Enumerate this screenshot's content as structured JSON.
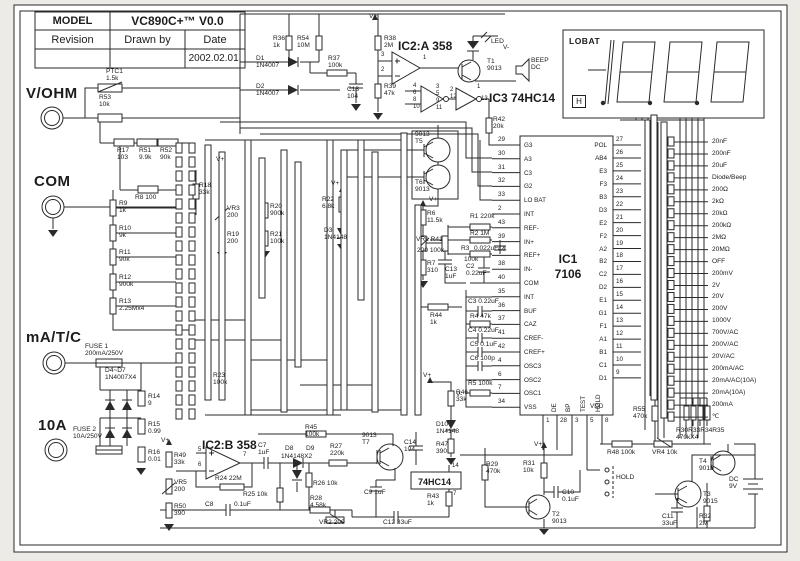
{
  "colors": {
    "ink": "#2a2a2a",
    "paper": "#ffffff"
  },
  "title_block": {
    "model_label": "MODEL",
    "model_value": "VC890C+™ V0.0",
    "revision_label": "Revision",
    "drawn_by_label": "Drawn by",
    "date_label": "Date",
    "date_value": "2002.02.01."
  },
  "display": {
    "lobat": "LOBAT",
    "hold": "H"
  },
  "ic1": {
    "name": "IC1",
    "part": "7106",
    "left_pins": [
      [
        "29",
        "G3"
      ],
      [
        "30",
        "A3"
      ],
      [
        "31",
        "C3"
      ],
      [
        "32",
        "G2"
      ],
      [
        "33",
        "LO BAT"
      ],
      [
        "2",
        "INT"
      ],
      [
        "43",
        "REF-"
      ],
      [
        "39",
        "IN+"
      ],
      [
        "44",
        "REF+"
      ],
      [
        "38",
        "IN-"
      ],
      [
        "40",
        "COM"
      ],
      [
        "35",
        "INT"
      ],
      [
        "36",
        "BUF"
      ],
      [
        "37",
        "CAZ"
      ],
      [
        "41",
        "CREF-"
      ],
      [
        "42",
        "CREF+"
      ],
      [
        "4",
        "OSC3"
      ],
      [
        "6",
        "OSC2"
      ],
      [
        "7",
        "OSC1"
      ],
      [
        "34",
        "VSS"
      ]
    ],
    "right_pins": [
      [
        "27",
        "POL"
      ],
      [
        "26",
        "AB4"
      ],
      [
        "25",
        "E3"
      ],
      [
        "24",
        "F3"
      ],
      [
        "23",
        "B3"
      ],
      [
        "22",
        "D3"
      ],
      [
        "21",
        "E2"
      ],
      [
        "20",
        "F2"
      ],
      [
        "19",
        "A2"
      ],
      [
        "18",
        "B2"
      ],
      [
        "17",
        "C2"
      ],
      [
        "16",
        "D2"
      ],
      [
        "15",
        "E1"
      ],
      [
        "14",
        "G1"
      ],
      [
        "13",
        "F1"
      ],
      [
        "12",
        "A1"
      ],
      [
        "11",
        "B1"
      ],
      [
        "10",
        "C1"
      ],
      [
        "9",
        "D1"
      ]
    ],
    "bottom_pins": [
      [
        "1",
        "DE"
      ],
      [
        "28",
        "BP"
      ],
      [
        "3",
        "TEST"
      ],
      [
        "5",
        "HOLD"
      ],
      [
        "8",
        "VDD"
      ]
    ]
  },
  "ranges": [
    "20nF",
    "200nF",
    "20uF",
    "Diode/Beep",
    "200Ω",
    "2kΩ",
    "20kΩ",
    "200kΩ",
    "2MΩ",
    "20MΩ",
    "OFF",
    "200mV",
    "2V",
    "20V",
    "200V",
    "1000V",
    "700V/AC",
    "200V/AC",
    "20V/AC",
    "200mA/AC",
    "20mA/AC(10A)",
    "20mA(10A)",
    "200mA",
    "℃"
  ],
  "labels": [
    {
      "t": "V/OHM",
      "x": 26,
      "y": 86,
      "c": "big"
    },
    {
      "t": "COM",
      "x": 34,
      "y": 174,
      "c": "big"
    },
    {
      "t": "mA/T/C",
      "x": 26,
      "y": 330,
      "c": "big"
    },
    {
      "t": "10A",
      "x": 38,
      "y": 418,
      "c": "big"
    },
    {
      "t": "PTC1\n1.5k",
      "x": 106,
      "y": 68
    },
    {
      "t": "R53\n10k",
      "x": 99,
      "y": 94
    },
    {
      "t": "R17\n103",
      "x": 117,
      "y": 147
    },
    {
      "t": "R51\n9.9k",
      "x": 139,
      "y": 147
    },
    {
      "t": "R52\n90k",
      "x": 160,
      "y": 147
    },
    {
      "t": "R8  100",
      "x": 135,
      "y": 194
    },
    {
      "t": "R9\n1k",
      "x": 119,
      "y": 200
    },
    {
      "t": "R10\n9k",
      "x": 119,
      "y": 225
    },
    {
      "t": "R11\n90k",
      "x": 119,
      "y": 249
    },
    {
      "t": "R12\n900k",
      "x": 119,
      "y": 274
    },
    {
      "t": "R13\n2.25Mx4",
      "x": 119,
      "y": 298
    },
    {
      "t": "FUSE 1\n200mA/250V",
      "x": 85,
      "y": 343
    },
    {
      "t": "D4~D7\n1N4007X4",
      "x": 105,
      "y": 367
    },
    {
      "t": "R14\n9",
      "x": 148,
      "y": 393
    },
    {
      "t": "R15\n0.99",
      "x": 148,
      "y": 421
    },
    {
      "t": "R16\n0.01",
      "x": 148,
      "y": 449
    },
    {
      "t": "FUSE 2\n10A/250V",
      "x": 73,
      "y": 426
    },
    {
      "t": "V+",
      "x": 161,
      "y": 437
    },
    {
      "t": "R49\n33k",
      "x": 174,
      "y": 452
    },
    {
      "t": "VR5\n200",
      "x": 174,
      "y": 479
    },
    {
      "t": "R50\n390",
      "x": 174,
      "y": 503
    },
    {
      "t": "V+",
      "x": 216,
      "y": 156
    },
    {
      "t": "R18\n33k",
      "x": 199,
      "y": 182
    },
    {
      "t": "VR3\n200",
      "x": 227,
      "y": 205
    },
    {
      "t": "R19\n200",
      "x": 227,
      "y": 231
    },
    {
      "t": "R20\n900k",
      "x": 270,
      "y": 203
    },
    {
      "t": "R21\n100k",
      "x": 270,
      "y": 231
    },
    {
      "t": "V+",
      "x": 331,
      "y": 180
    },
    {
      "t": "R22\n6.8k",
      "x": 322,
      "y": 196
    },
    {
      "t": "D3\n1N4148",
      "x": 324,
      "y": 227
    },
    {
      "t": "R23\n100k",
      "x": 213,
      "y": 372
    },
    {
      "t": "R36\n1k",
      "x": 273,
      "y": 35
    },
    {
      "t": "R54\n10M",
      "x": 297,
      "y": 35
    },
    {
      "t": "D1\n1N4007",
      "x": 256,
      "y": 55
    },
    {
      "t": "D2\n1N4007",
      "x": 256,
      "y": 83
    },
    {
      "t": "R37\n100k",
      "x": 328,
      "y": 55
    },
    {
      "t": "C13\n104",
      "x": 347,
      "y": 86
    },
    {
      "t": "V+",
      "x": 369,
      "y": 13
    },
    {
      "t": "R38\n2M",
      "x": 384,
      "y": 35
    },
    {
      "t": "R39\n47k",
      "x": 384,
      "y": 83
    },
    {
      "t": "IC2:A 358",
      "x": 398,
      "y": 40,
      "c": "ic"
    },
    {
      "t": "3",
      "x": 381,
      "y": 52,
      "c": "pin"
    },
    {
      "t": "2",
      "x": 381,
      "y": 67,
      "c": "pin"
    },
    {
      "t": "1",
      "x": 423,
      "y": 55,
      "c": "pin"
    },
    {
      "t": "LED",
      "x": 491,
      "y": 38
    },
    {
      "t": "V-",
      "x": 503,
      "y": 44
    },
    {
      "t": "T1\n9013",
      "x": 487,
      "y": 58
    },
    {
      "t": "BEEP\nDC",
      "x": 531,
      "y": 57
    },
    {
      "t": "IC3  74HC14",
      "x": 489,
      "y": 92,
      "c": "ic"
    },
    {
      "t": "4\n6\n8\n10",
      "x": 413,
      "y": 83,
      "c": "pin"
    },
    {
      "t": "3\n5\n9\n11",
      "x": 436,
      "y": 84,
      "c": "pin"
    },
    {
      "t": "2\n12",
      "x": 450,
      "y": 87,
      "c": "pin"
    },
    {
      "t": "1",
      "x": 477,
      "y": 84,
      "c": "pin"
    },
    {
      "t": "13",
      "x": 481,
      "y": 96,
      "c": "pin"
    },
    {
      "t": "R42\n20k",
      "x": 493,
      "y": 116
    },
    {
      "t": "9013\nT5",
      "x": 415,
      "y": 131
    },
    {
      "t": "T6\n9013",
      "x": 415,
      "y": 179
    },
    {
      "t": "V+",
      "x": 429,
      "y": 196
    },
    {
      "t": "R6\n11.5k",
      "x": 427,
      "y": 210
    },
    {
      "t": "VR1 R41",
      "x": 416,
      "y": 236
    },
    {
      "t": "200 100k",
      "x": 417,
      "y": 247
    },
    {
      "t": "R7\n310",
      "x": 427,
      "y": 260
    },
    {
      "t": "C13\n1uF",
      "x": 445,
      "y": 266
    },
    {
      "t": "R1 220k",
      "x": 470,
      "y": 213
    },
    {
      "t": "R2 1M",
      "x": 470,
      "y": 230
    },
    {
      "t": "R3",
      "x": 461,
      "y": 245
    },
    {
      "t": "0.022uFC1",
      "x": 474,
      "y": 245
    },
    {
      "t": "100k",
      "x": 464,
      "y": 256
    },
    {
      "t": "C2\n0.22uF",
      "x": 466,
      "y": 263
    },
    {
      "t": "C3  0.22uF",
      "x": 468,
      "y": 298
    },
    {
      "t": "R4   47k",
      "x": 470,
      "y": 313
    },
    {
      "t": "C4  0.22uF",
      "x": 468,
      "y": 327
    },
    {
      "t": "C5  0.1uF",
      "x": 470,
      "y": 341
    },
    {
      "t": "C6  100p",
      "x": 470,
      "y": 355
    },
    {
      "t": "R5  100k",
      "x": 468,
      "y": 380
    },
    {
      "t": "V-",
      "x": 456,
      "y": 391
    },
    {
      "t": "R44\n1k",
      "x": 430,
      "y": 312
    },
    {
      "t": "V+",
      "x": 423,
      "y": 372
    },
    {
      "t": "R46\n33k",
      "x": 456,
      "y": 389
    },
    {
      "t": "D10\n1N4148",
      "x": 436,
      "y": 421
    },
    {
      "t": "R47\n390",
      "x": 436,
      "y": 441
    },
    {
      "t": "C14\n104",
      "x": 404,
      "y": 439
    },
    {
      "t": "R45\n100k",
      "x": 305,
      "y": 424
    },
    {
      "t": "9013\nT7",
      "x": 362,
      "y": 432
    },
    {
      "t": "IC2:B 358",
      "x": 202,
      "y": 439,
      "c": "ic"
    },
    {
      "t": "5",
      "x": 198,
      "y": 447,
      "c": "pin"
    },
    {
      "t": "6",
      "x": 198,
      "y": 462,
      "c": "pin"
    },
    {
      "t": "7",
      "x": 243,
      "y": 452,
      "c": "pin"
    },
    {
      "t": "R24 22M",
      "x": 215,
      "y": 475
    },
    {
      "t": "C7\n1uF",
      "x": 258,
      "y": 442
    },
    {
      "t": "D8",
      "x": 285,
      "y": 445
    },
    {
      "t": "D9",
      "x": 306,
      "y": 445
    },
    {
      "t": "1N4148X2",
      "x": 281,
      "y": 453
    },
    {
      "t": "R27\n220k",
      "x": 330,
      "y": 443
    },
    {
      "t": "R26 10k",
      "x": 313,
      "y": 480
    },
    {
      "t": "R25 10k",
      "x": 243,
      "y": 491
    },
    {
      "t": "R28\n4.58k",
      "x": 310,
      "y": 495
    },
    {
      "t": "C8",
      "x": 205,
      "y": 501
    },
    {
      "t": "0.1uF",
      "x": 234,
      "y": 501
    },
    {
      "t": "VR2 200",
      "x": 319,
      "y": 519
    },
    {
      "t": "C9  1uF",
      "x": 364,
      "y": 489
    },
    {
      "t": "C12  33uF",
      "x": 383,
      "y": 519
    },
    {
      "t": "74HC14",
      "x": 418,
      "y": 477,
      "c": "boxlbl"
    },
    {
      "t": "14",
      "x": 452,
      "y": 463,
      "c": "pin"
    },
    {
      "t": "7",
      "x": 453,
      "y": 491,
      "c": "pin"
    },
    {
      "t": "R43\n1k",
      "x": 427,
      "y": 493
    },
    {
      "t": "V+",
      "x": 534,
      "y": 441
    },
    {
      "t": "R29\n470k",
      "x": 486,
      "y": 461
    },
    {
      "t": "R31\n10k",
      "x": 523,
      "y": 460
    },
    {
      "t": "C10\n0.1uF",
      "x": 562,
      "y": 489
    },
    {
      "t": "T2\n9013",
      "x": 552,
      "y": 511
    },
    {
      "t": "R55\n470k",
      "x": 633,
      "y": 406
    },
    {
      "t": "R30R33R34R35\n470kX4",
      "x": 676,
      "y": 427
    },
    {
      "t": "R48  100k",
      "x": 607,
      "y": 449
    },
    {
      "t": "VR4  10k",
      "x": 652,
      "y": 449
    },
    {
      "t": "HOLD",
      "x": 616,
      "y": 474
    },
    {
      "t": "T4\n9015",
      "x": 699,
      "y": 458
    },
    {
      "t": "T3\n9015",
      "x": 703,
      "y": 491
    },
    {
      "t": "DC\n9V",
      "x": 729,
      "y": 476
    },
    {
      "t": "C11\n33uF",
      "x": 662,
      "y": 513
    },
    {
      "t": "R32\n2M",
      "x": 699,
      "y": 513
    }
  ]
}
